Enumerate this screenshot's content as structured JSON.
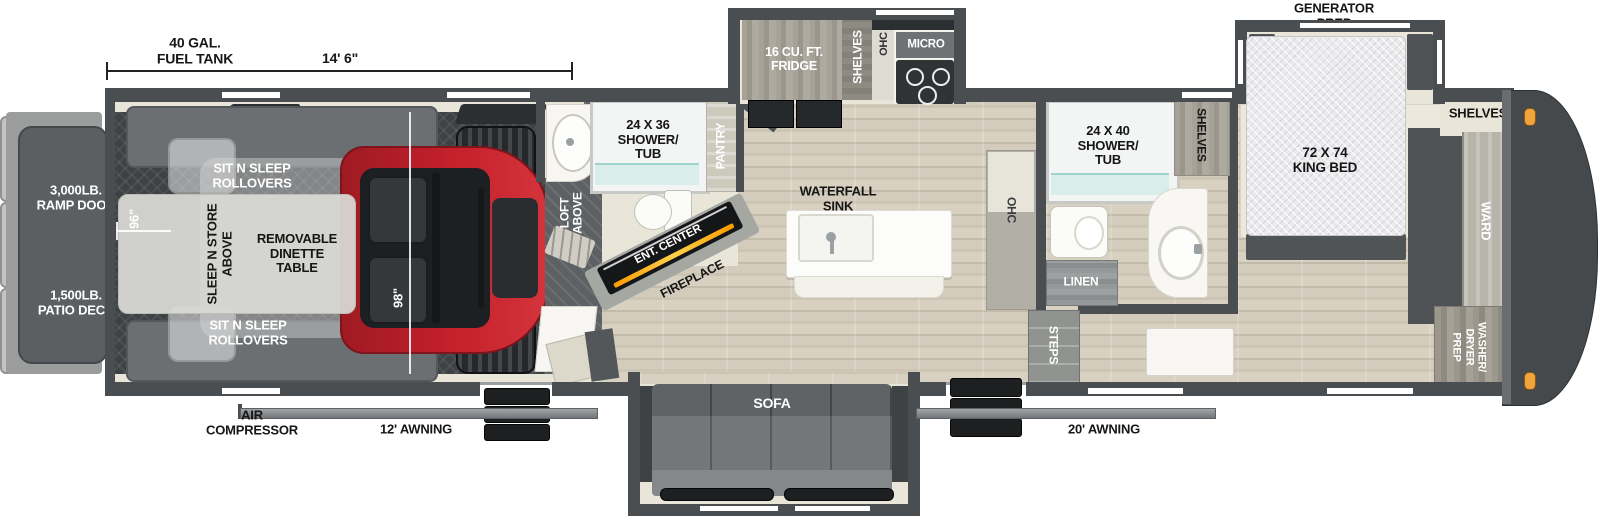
{
  "colors": {
    "wall": "#4a4e50",
    "floor_beige": "#e9e6d9",
    "utv_red": "#c5202b",
    "marker_light_orange": "#f2a43c",
    "fireplace_glow": "#ff9a00"
  },
  "top_dimension": {
    "tank_line1": "40 GAL.",
    "tank_line2": "FUEL TANK",
    "length": "14' 6\""
  },
  "generator_prep": {
    "line1": "GENERATOR",
    "line2": "PREP"
  },
  "rear": {
    "ramp_weight": "3,000LB.",
    "ramp_label": "RAMP DOOR",
    "patio_weight": "1,500LB.",
    "patio_label": "PATIO DECK",
    "width_dim": "96\""
  },
  "garage": {
    "rollover_top_line1": "SIT N SLEEP",
    "rollover_top_line2": "ROLLOVERS",
    "rollover_bottom_line1": "SIT N SLEEP",
    "rollover_bottom_line2": "ROLLOVERS",
    "sleep_store_line1": "SLEEP N STORE",
    "sleep_store_line2": "ABOVE",
    "dinette_line1": "REMOVABLE",
    "dinette_line2": "DINETTE",
    "dinette_line3": "TABLE",
    "height_dim": "98\"",
    "loft_line1": "LOFT",
    "loft_line2": "ABOVE"
  },
  "mid_bath": {
    "shower_line1": "24 X 36",
    "shower_line2": "SHOWER/",
    "shower_line3": "TUB",
    "pantry": "PANTRY"
  },
  "living": {
    "ent_center": "ENT. CENTER",
    "fireplace": "FIREPLACE",
    "sofa": "SOFA"
  },
  "kitchen": {
    "fridge_line1": "16 CU. FT.",
    "fridge_line2": "FRIDGE",
    "shelves": "SHELVES",
    "ohc": "OHC",
    "micro": "MICRO",
    "waterfall_line1": "WATERFALL",
    "waterfall_line2": "SINK",
    "ohc_island": "OHC"
  },
  "main_bath": {
    "shower_line1": "24 X 40",
    "shower_line2": "SHOWER/",
    "shower_line3": "TUB",
    "shelves": "SHELVES",
    "linen": "LINEN",
    "steps": "STEPS"
  },
  "bedroom": {
    "bed_line1": "72 X 74",
    "bed_line2": "KING BED",
    "shelves": "SHELVES",
    "ward": "WARD",
    "wd_line1": "WASHER/",
    "wd_line2": "DRYER",
    "wd_line3": "PREP"
  },
  "exterior": {
    "air_line1": "AIR",
    "air_line2": "COMPRESSOR",
    "awning_left": "12' AWNING",
    "awning_right": "20' AWNING"
  }
}
